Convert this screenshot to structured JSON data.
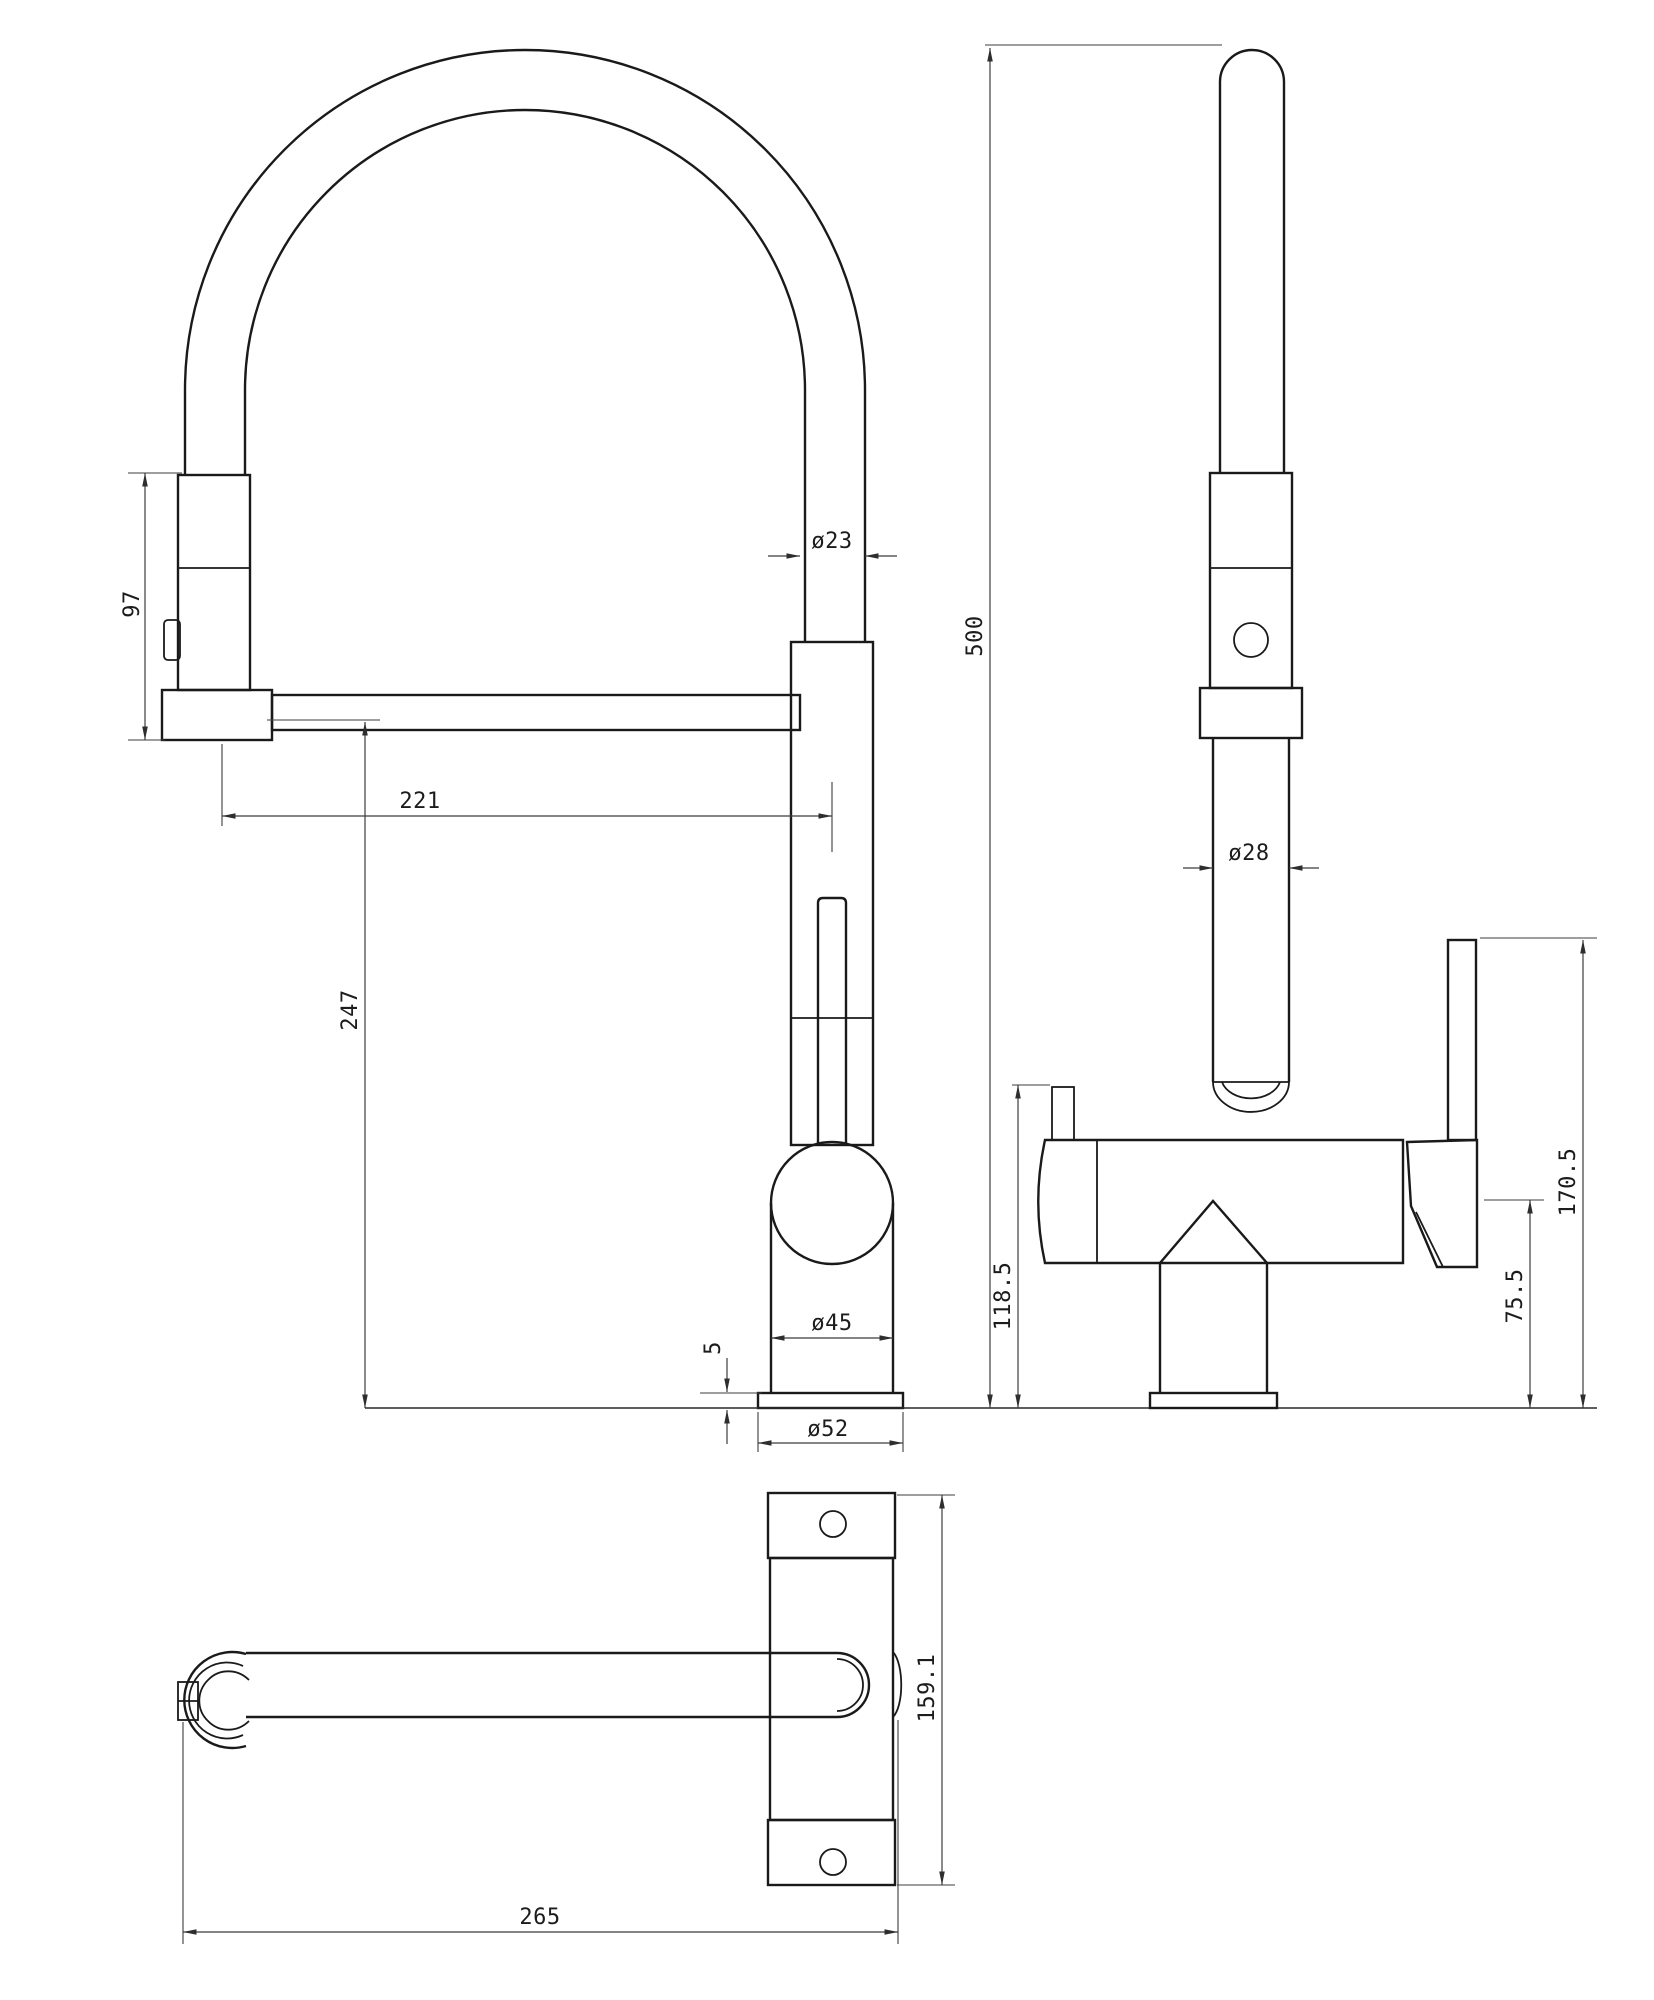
{
  "drawing": {
    "type": "technical-dimension-drawing",
    "subject": "pull-out spring kitchen faucet, three orthographic views",
    "background_color": "#ffffff",
    "line_color": "#1a1a1a",
    "dimension_line_color": "#3c3c3c",
    "views": {
      "front_view": {
        "name": "front-view",
        "dims": {
          "spray_head_height": "97",
          "hose_diameter": "ø23",
          "spout_reach": "221",
          "spout_outlet_height": "247",
          "body_diameter": "ø45",
          "base_plate_thickness": "5",
          "base_diameter": "ø52"
        }
      },
      "side_view": {
        "name": "side-view",
        "dims": {
          "overall_height": "500",
          "column_diameter": "ø28",
          "body_top_height": "118.5",
          "handle_pivot_height": "75.5",
          "lever_top_height": "170.5"
        }
      },
      "plan_view": {
        "name": "plan-view",
        "dims": {
          "footprint_length": "159.1",
          "overall_depth": "265"
        }
      }
    }
  }
}
